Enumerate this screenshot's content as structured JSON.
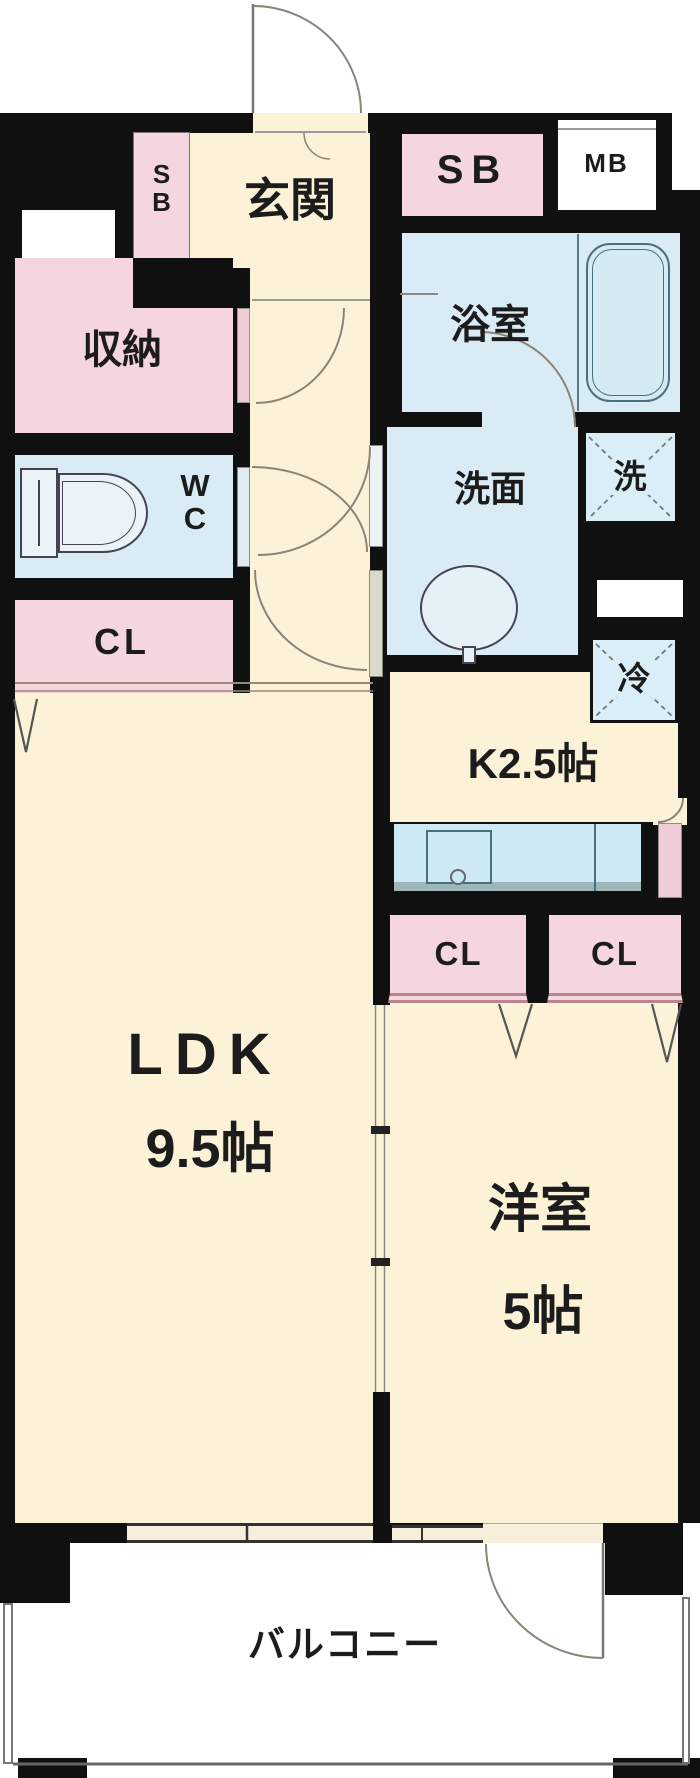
{
  "palette": {
    "wall": "#101010",
    "cream": "#fbf2d8",
    "pink": "#f6d6de",
    "blue": "#d9ebf4",
    "boxblue": "#d9eef6",
    "counter": "#cde9f3",
    "line": "#8a8578"
  },
  "labels": {
    "entrance": "玄関",
    "shoe_box_vertical": "SB",
    "shoe_box": "SB",
    "meter_box": "MB",
    "bathroom": "浴室",
    "storage": "収納",
    "toilet": "WC",
    "washroom": "洗面",
    "washer": "洗",
    "closet_hall": "CL",
    "refrigerator": "冷",
    "kitchen": "K2.5帖",
    "closet_left": "CL",
    "closet_right": "CL",
    "ldk": "LDK",
    "ldk_size": "9.5帖",
    "western_room": "洋室",
    "western_room_size": "5帖",
    "balcony": "バルコニー"
  },
  "fixtures": [
    "bathtub",
    "toilet",
    "wash-basin",
    "kitchen-counter",
    "kitchen-sink",
    "washing-machine-space",
    "refrigerator-space",
    "entry-door",
    "balcony-door",
    "sliding-door",
    "window"
  ]
}
